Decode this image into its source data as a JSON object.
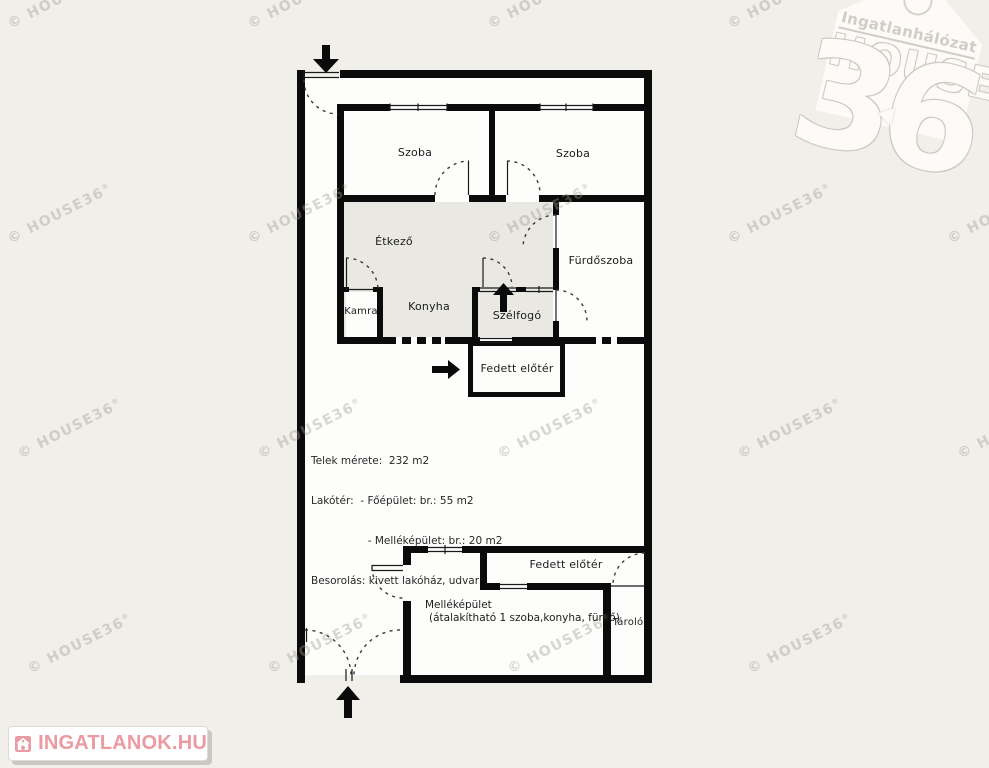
{
  "page": {
    "background_color": "#f0efe9",
    "wall_color": "#0b0b0b",
    "gray_room_color": "#e9e8e2",
    "interior_color": "#fdfdfb"
  },
  "plan": {
    "rooms": [
      {
        "id": "szoba-left",
        "label": "Szoba"
      },
      {
        "id": "szoba-right",
        "label": "Szoba"
      },
      {
        "id": "etkezo",
        "label": "Étkező"
      },
      {
        "id": "furdoszoba",
        "label": "Fürdőszoba"
      },
      {
        "id": "kamra",
        "label": "Kamra"
      },
      {
        "id": "konyha",
        "label": "Konyha"
      },
      {
        "id": "szelfogo",
        "label": "Szélfogó"
      },
      {
        "id": "fedett-eloter-felso",
        "label": "Fedett előtér"
      },
      {
        "id": "fedett-eloter-also",
        "label": "Fedett előtér"
      },
      {
        "id": "tarolo",
        "label": "Tároló"
      }
    ],
    "outbuilding": {
      "name": "Melléképület",
      "note": "(átalakítható 1 szoba,konyha, fürdő)"
    },
    "info": {
      "lines": [
        "Telek mérete:  232 m2",
        "Lakótér:  - Főépület: br.: 55 m2",
        "                 - Melléképület: br.: 20 m2",
        "Besorolás: kivett lakóház, udvar"
      ]
    }
  },
  "watermark": {
    "text": "© HOUSE36",
    "mark": "®",
    "color": "rgba(158,154,143,0.40)",
    "positions": [
      [
        5,
        18
      ],
      [
        245,
        18
      ],
      [
        485,
        18
      ],
      [
        725,
        18
      ],
      [
        5,
        233
      ],
      [
        245,
        233
      ],
      [
        485,
        233
      ],
      [
        725,
        233
      ],
      [
        945,
        233
      ],
      [
        15,
        448
      ],
      [
        255,
        448
      ],
      [
        495,
        448
      ],
      [
        735,
        448
      ],
      [
        955,
        448
      ],
      [
        25,
        663
      ],
      [
        265,
        663
      ],
      [
        505,
        663
      ],
      [
        745,
        663
      ]
    ]
  },
  "logo36": {
    "subtitle": "Ingatlanhálózat",
    "title": "HOUSE",
    "number": "36",
    "outline_color": "#cdcbc4"
  },
  "badge": {
    "label": "INGATLANOK.HU",
    "accent_color": "#eb9aa1"
  }
}
